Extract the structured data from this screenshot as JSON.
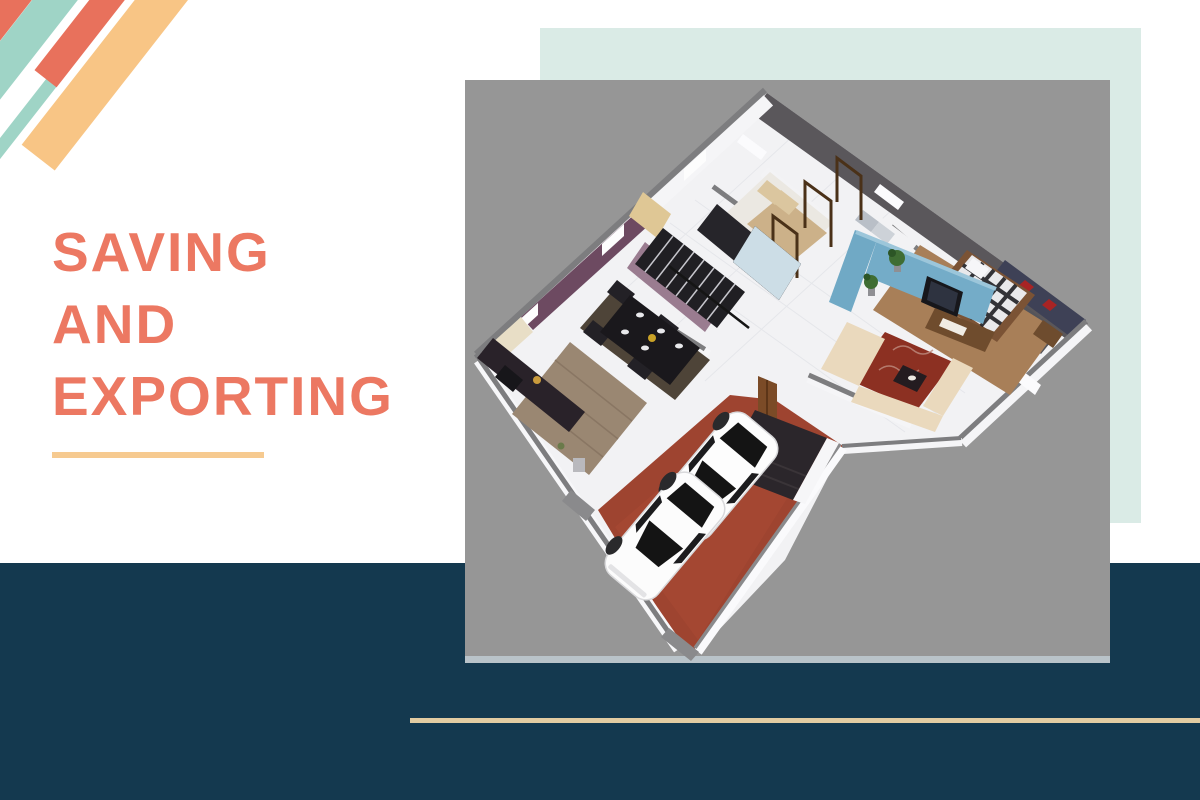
{
  "slide": {
    "title": {
      "lines": [
        "SAVING",
        "AND",
        "EXPORTING"
      ],
      "full_text": "SAVING AND EXPORTING"
    },
    "colors": {
      "title": "#EC7862",
      "underline": "#F6CA90",
      "footer": "#14394F",
      "rule": "#E2CCA2",
      "backdrop": "#DAEBE6",
      "photo_bg": "#969696",
      "stripe_coral": "#E8715C",
      "stripe_teal": "#9FD4C6",
      "stripe_orange": "#F8C585"
    },
    "image": {
      "description": "Isometric 3D rendered floor plan of a single-storey house with furnished bedrooms, kitchen, dining and living rooms, and two white cars parked on a terracotta driveway"
    }
  }
}
